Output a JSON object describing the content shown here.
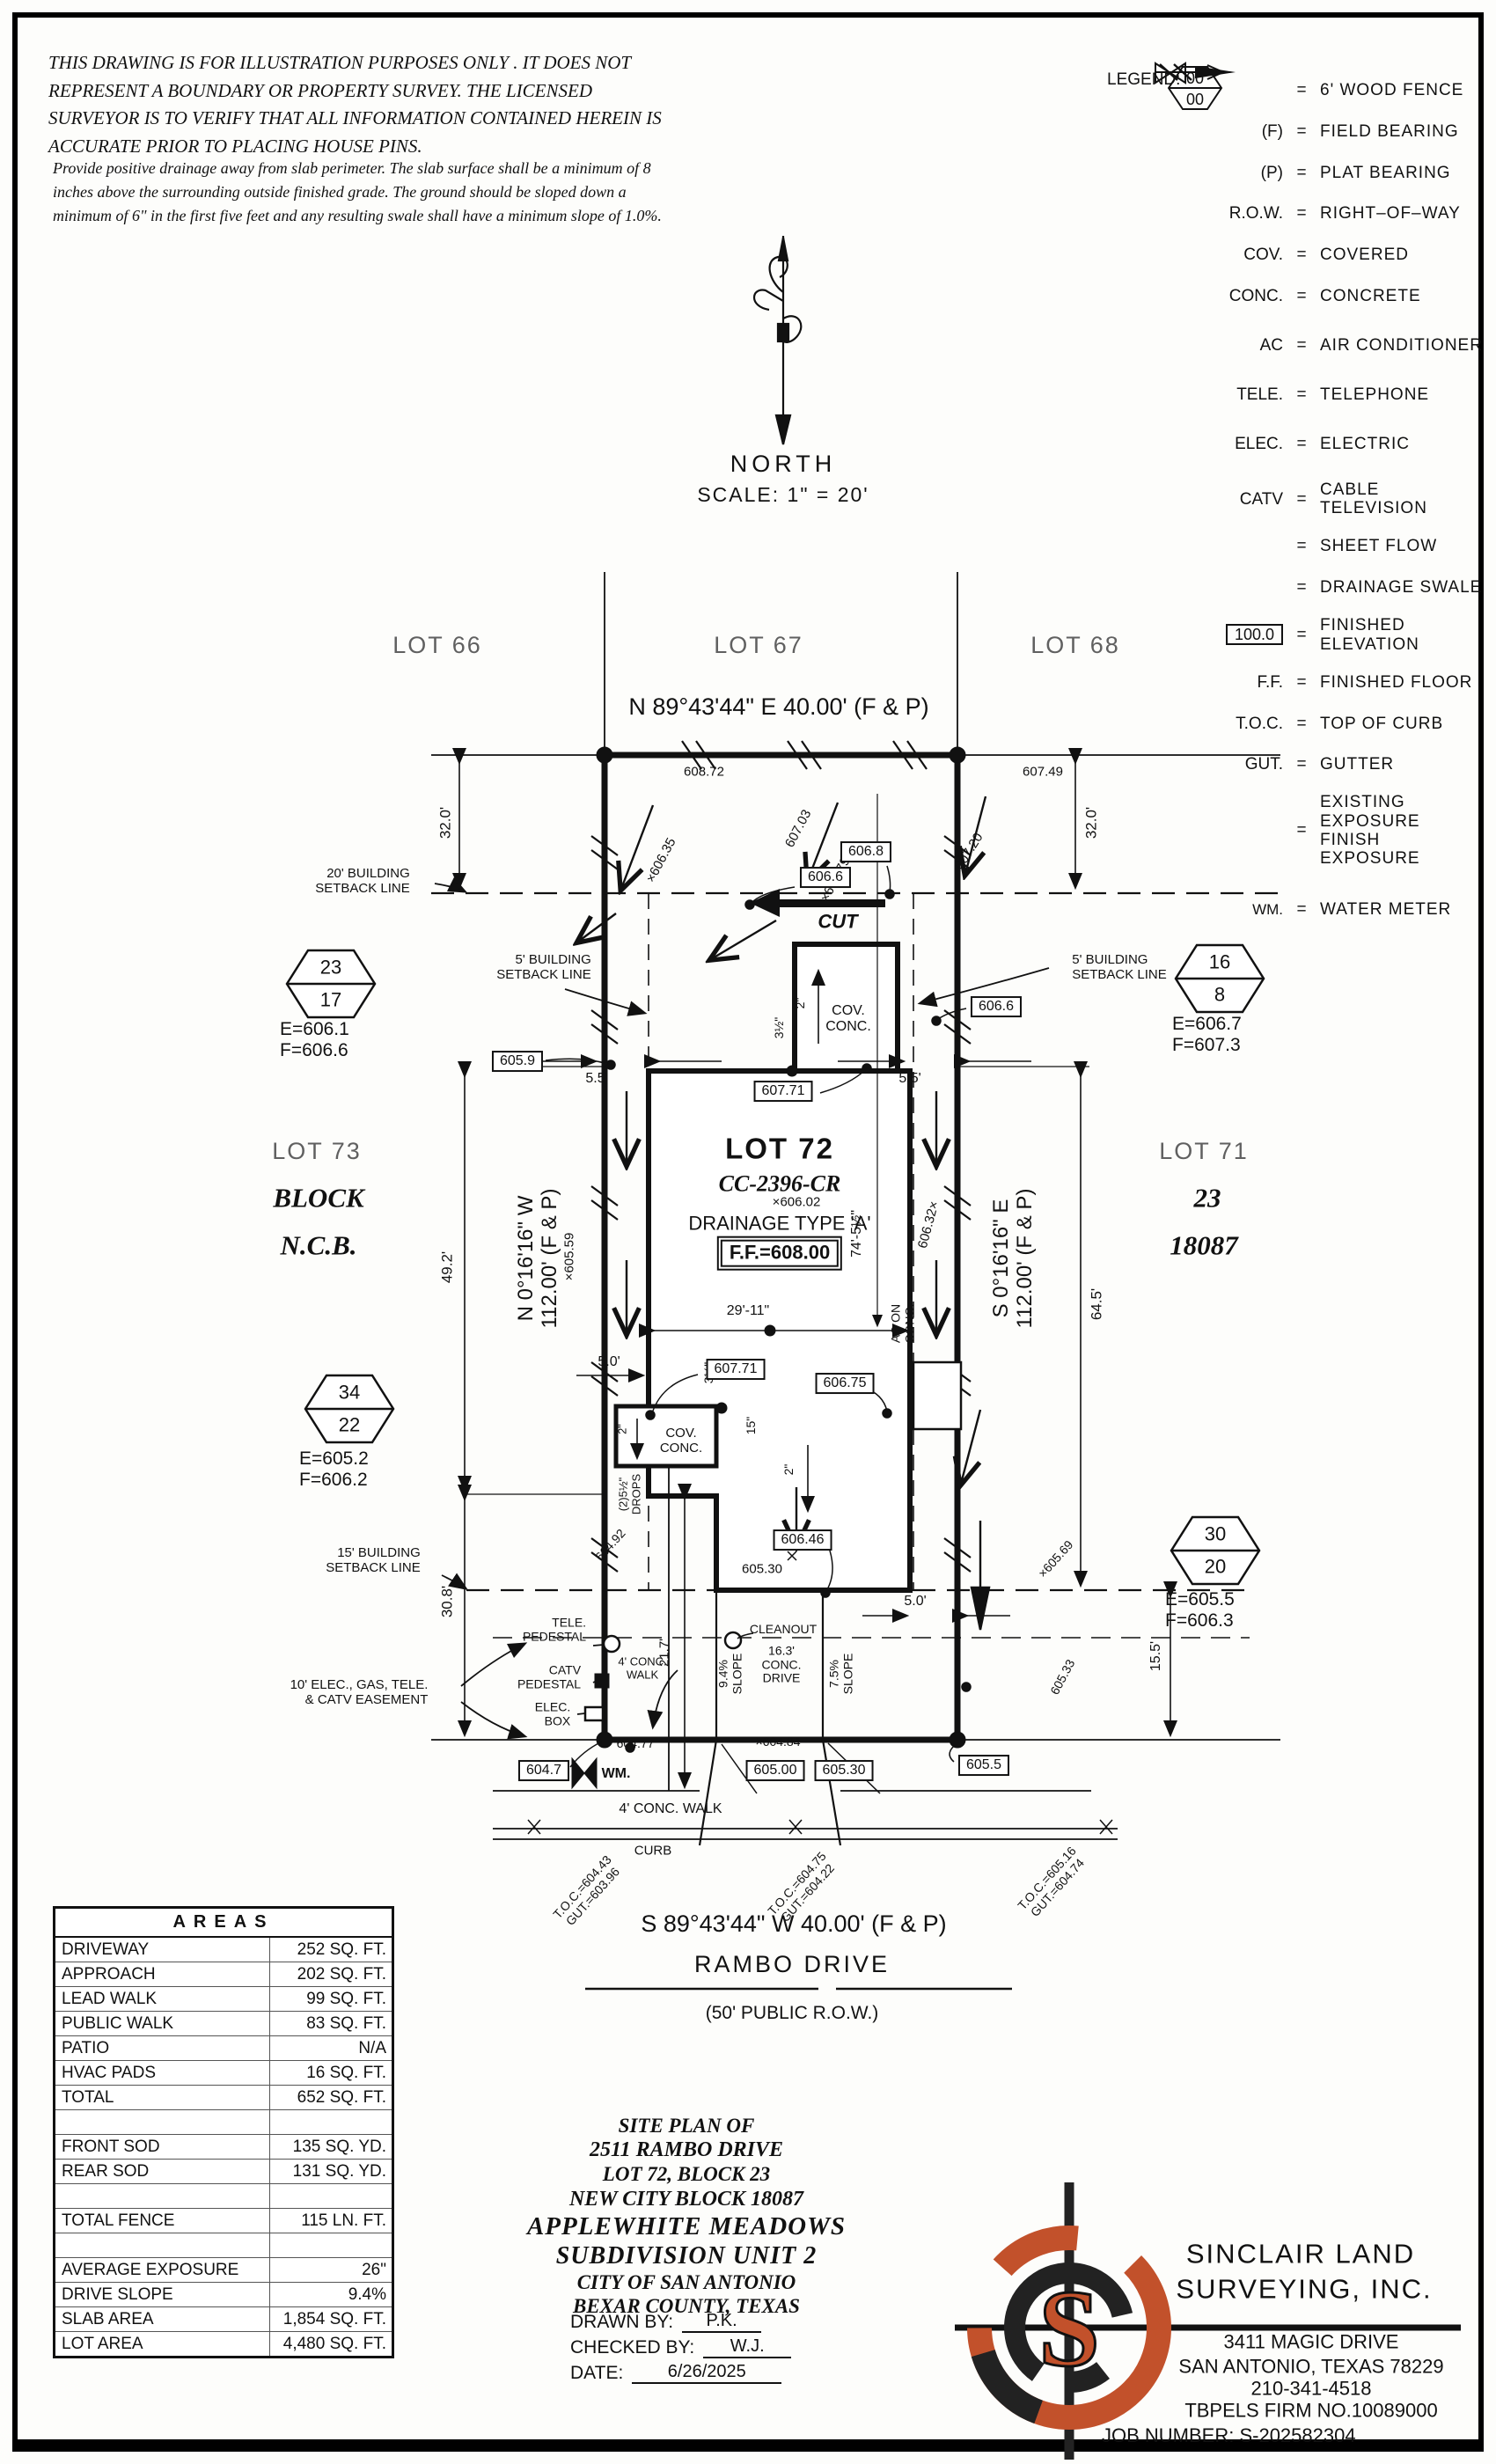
{
  "disclaimer": {
    "p1": "THIS DRAWING IS FOR ILLUSTRATION PURPOSES ONLY . IT DOES NOT REPRESENT A BOUNDARY OR PROPERTY SURVEY. THE LICENSED SURVEYOR IS TO VERIFY THAT ALL INFORMATION CONTAINED HEREIN IS ACCURATE PRIOR TO PLACING HOUSE PINS.",
    "p2": "Provide positive drainage away from slab perimeter. The slab surface shall be a minimum of 8 inches above the surrounding outside finished grade. The ground should be sloped down a minimum of 6\" in the first five feet and any resulting swale shall have a minimum slope of 1.0%."
  },
  "legend": {
    "title": "LEGEND:",
    "eq": "=",
    "items": [
      {
        "sym": "",
        "def": "6' WOOD FENCE"
      },
      {
        "sym": "(F)",
        "def": "FIELD BEARING"
      },
      {
        "sym": "(P)",
        "def": "PLAT BEARING"
      },
      {
        "sym": "R.O.W.",
        "def": "RIGHT–OF–WAY"
      },
      {
        "sym": "COV.",
        "def": "COVERED"
      },
      {
        "sym": "CONC.",
        "def": "CONCRETE"
      },
      {
        "sym": "AC",
        "def": "AIR CONDITIONER"
      },
      {
        "sym": "TELE.",
        "def": "TELEPHONE"
      },
      {
        "sym": "ELEC.",
        "def": "ELECTRIC"
      },
      {
        "sym": "CATV",
        "def": "CABLE TELEVISION"
      },
      {
        "sym": "",
        "def": "SHEET FLOW"
      },
      {
        "sym": "",
        "def": "DRAINAGE SWALE"
      },
      {
        "sym": "100.0",
        "def": "FINISHED ELEVATION"
      },
      {
        "sym": "F.F.",
        "def": "FINISHED FLOOR"
      },
      {
        "sym": "T.O.C.",
        "def": "TOP OF CURB"
      },
      {
        "sym": "GUT.",
        "def": "GUTTER"
      },
      {
        "sym": "00",
        "sym2": "00",
        "def": "EXISTING EXPOSURE",
        "def2": "FINISH EXPOSURE"
      },
      {
        "sym": "WM.",
        "def": "WATER METER"
      }
    ]
  },
  "compass": {
    "north": "NORTH",
    "scale": "SCALE: 1\" = 20'"
  },
  "plan": {
    "lots": {
      "lot66": "LOT 66",
      "lot67": "LOT 67",
      "lot68": "LOT 68",
      "lot73": "LOT 73",
      "lot71": "LOT 71",
      "block": "BLOCK",
      "ncb": "N.C.B.",
      "blk23": "23",
      "blk18087": "18087"
    },
    "lot72": {
      "name": "LOT 72",
      "cc": "CC-2396-CR",
      "elev": "×606.02",
      "drainage": "DRAINAGE TYPE 'A'",
      "ff": "F.F.=608.00"
    },
    "bearings": {
      "top": "N 89°43'44\" E 40.00' (F & P)",
      "bottom": "S 89°43'44\" W 40.00' (F & P)",
      "left": "N 0°16'16\" W\n112.00' (F & P)",
      "right": "S 0°16'16\" E\n112.00' (F & P)"
    },
    "street": {
      "name": "RAMBO DRIVE",
      "row": "(50' PUBLIC R.O.W.)"
    },
    "dims": {
      "d32l": "32.0'",
      "d32r": "32.0'",
      "d49": "49.2'",
      "d308": "30.8'",
      "d645": "64.5'",
      "d155": "15.5'",
      "d55l": "5.5'",
      "d55r": "5.5'",
      "d50l": "5.0'",
      "d50r": "5.0'",
      "d2911": "29'-11\"",
      "d745": "74'-5½\"",
      "d217": "21.7'",
      "d2a": "2\"",
      "d2b": "2\"",
      "d2c": "2\"",
      "d35a": "3½\"",
      "d35b": "3½\"",
      "d15in": "15\"",
      "d163": "16.3'\nCONC.\nDRIVE",
      "s94": "9.4%\nSLOPE",
      "s75": "7.5%\nSLOPE"
    },
    "elev": {
      "e60872": "608.72",
      "e60703": "607.03",
      "e60749": "607.49",
      "e60635": "×606.35",
      "e60679": "×606.79",
      "e60720": "607.20",
      "b6068": "606.8",
      "b6066a": "606.6",
      "b6066b": "606.6",
      "b6059": "605.9",
      "b60771a": "607.71",
      "b60771b": "607.71",
      "b60675": "606.75",
      "b60646": "606.46",
      "e60530a": "605.30",
      "e60559": "×605.59",
      "e60492": "604.92",
      "drops": "(2)5½\"\nDROPS",
      "e60632": "606.32×",
      "e60569": "×605.69",
      "e60533": "605.33",
      "e60477": "604.77",
      "b6047": "604.7",
      "e60484": "×604.84",
      "b60500": "605.00",
      "b60530": "605.30",
      "b6055": "605.5"
    },
    "notes": {
      "sb20": "20' BUILDING\nSETBACK LINE",
      "sb5l": "5' BUILDING\nSETBACK LINE",
      "sb5r": "5' BUILDING\nSETBACK LINE",
      "sb15": "15' BUILDING\nSETBACK LINE",
      "easement": "10' ELEC., GAS, TELE.\n& CATV EASEMENT",
      "tele": "TELE.\nPEDESTAL",
      "catv": "CATV\nPEDESTAL",
      "elec": "ELEC.\nBOX",
      "walkside": "4' CONC.\nWALK",
      "walkbot": "4' CONC. WALK",
      "curb": "CURB",
      "cleanout": "CLEANOUT",
      "wm": "WM.",
      "cut": "CUT",
      "cov1": "COV.\nCONC.",
      "cov2": "COV.\nCONC.",
      "ac": "AC ON\nCONC."
    },
    "toc": {
      "t1": "T.O.C.=604.43\nGUT.=603.96",
      "t2": "T.O.C.=604.75\nGUT.=604.22",
      "t3": "T.O.C.=605.16\nGUT.=604.74"
    },
    "hex": {
      "h1t": "23",
      "h1b": "17",
      "h1e": "E=606.1",
      "h1f": "F=606.6",
      "h2t": "16",
      "h2b": "8",
      "h2e": "E=606.7",
      "h2f": "F=607.3",
      "h3t": "34",
      "h3b": "22",
      "h3e": "E=605.2",
      "h3f": "F=606.2",
      "h4t": "30",
      "h4b": "20",
      "h4e": "E=605.5",
      "h4f": "F=606.3"
    }
  },
  "areas": {
    "title": "AREAS",
    "rows": [
      [
        "DRIVEWAY",
        "252 SQ. FT."
      ],
      [
        "APPROACH",
        "202 SQ. FT."
      ],
      [
        "LEAD WALK",
        "99 SQ. FT."
      ],
      [
        "PUBLIC WALK",
        "83 SQ. FT."
      ],
      [
        "PATIO",
        "N/A"
      ],
      [
        "HVAC PADS",
        "16 SQ. FT."
      ],
      [
        "TOTAL",
        "652 SQ. FT."
      ],
      [
        "",
        ""
      ],
      [
        "FRONT SOD",
        "135 SQ. YD."
      ],
      [
        "REAR SOD",
        "131 SQ. YD."
      ],
      [
        "",
        ""
      ],
      [
        "TOTAL FENCE",
        "115 LN. FT."
      ],
      [
        "",
        ""
      ],
      [
        "AVERAGE EXPOSURE",
        "26\""
      ],
      [
        "DRIVE SLOPE",
        "9.4%"
      ],
      [
        "SLAB AREA",
        "1,854 SQ. FT."
      ],
      [
        "LOT AREA",
        "4,480 SQ. FT."
      ]
    ]
  },
  "title_block": {
    "lines": [
      "SITE PLAN OF",
      "2511 RAMBO DRIVE",
      "LOT 72, BLOCK 23",
      "NEW CITY BLOCK 18087",
      "APPLEWHITE MEADOWS",
      "SUBDIVISION UNIT 2",
      "CITY OF SAN ANTONIO",
      "BEXAR COUNTY, TEXAS"
    ],
    "drawn_label": "DRAWN BY:",
    "drawn": "P.K.",
    "checked_label": "CHECKED BY:",
    "checked": "W.J.",
    "date_label": "DATE:",
    "date": "6/26/2025"
  },
  "firm": {
    "logo_letter": "S",
    "l1": "SINCLAIR LAND",
    "l2": "SURVEYING, INC.",
    "a1": "3411 MAGIC DRIVE",
    "a2": "SAN ANTONIO, TEXAS 78229",
    "a3": "210-341-4518",
    "a4": "TBPELS FIRM NO.10089000",
    "job": "JOB NUMBER: S-202582304",
    "accent": "#c2512b"
  }
}
